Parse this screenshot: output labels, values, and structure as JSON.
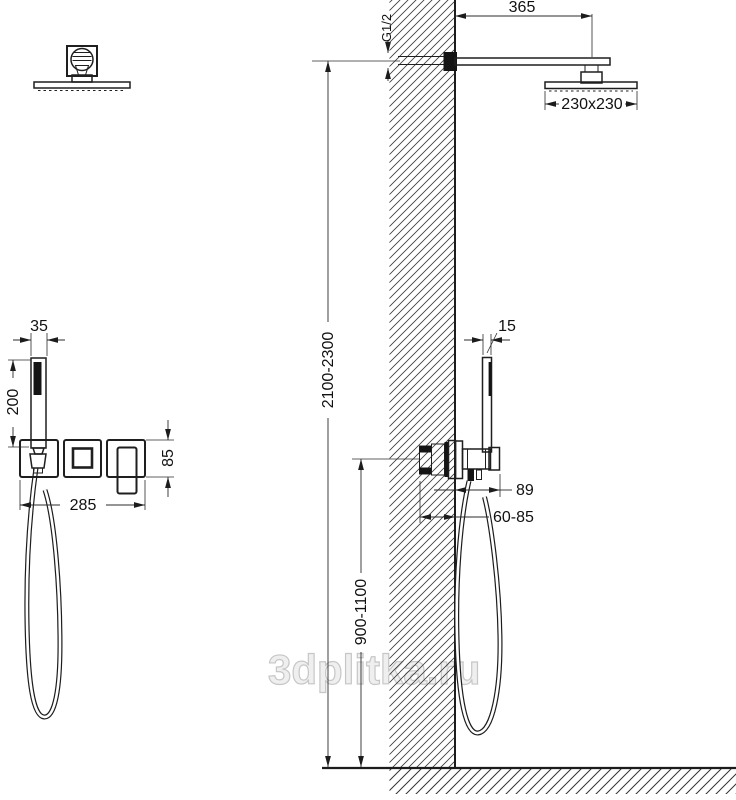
{
  "watermark": "3dplitka.ru",
  "dimensions": {
    "arm_length": "365",
    "wall_thread": "G1/2",
    "head_size": "230x230",
    "install_height": "2100-2300",
    "mixer_height": "900-1100",
    "handshower_width_front": "35",
    "handshower_length": "200",
    "trim_width": "285",
    "trim_height": "85",
    "handshower_width_side": "15",
    "holder_offset": "89",
    "embed_depth": "60-85"
  }
}
